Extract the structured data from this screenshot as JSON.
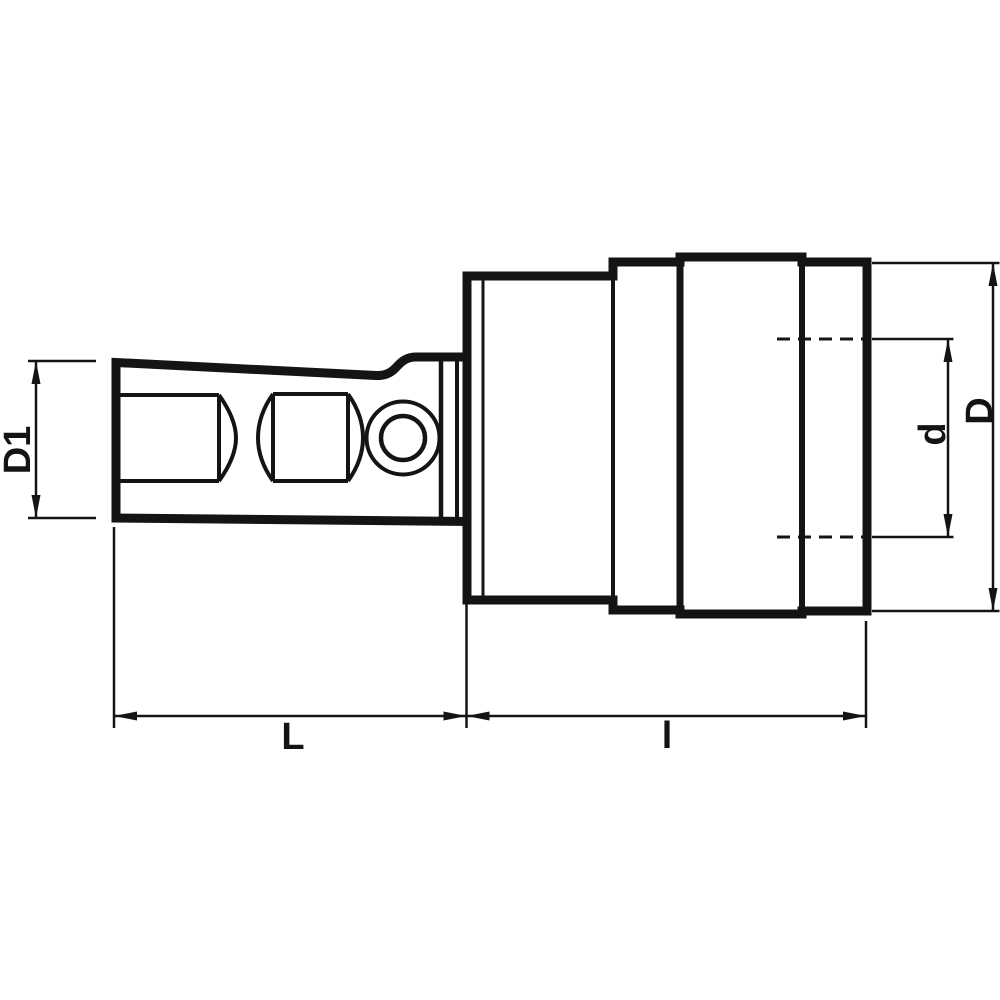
{
  "diagram": {
    "type": "engineering-drawing",
    "subject": "tool-holder-adapter-side-view",
    "background_color": "#ffffff",
    "line_color": "#141414",
    "labels": {
      "shank_diameter": "D1",
      "shank_length": "L",
      "body_length": "l",
      "body_diameter": "D",
      "bore_diameter": "d"
    }
  }
}
